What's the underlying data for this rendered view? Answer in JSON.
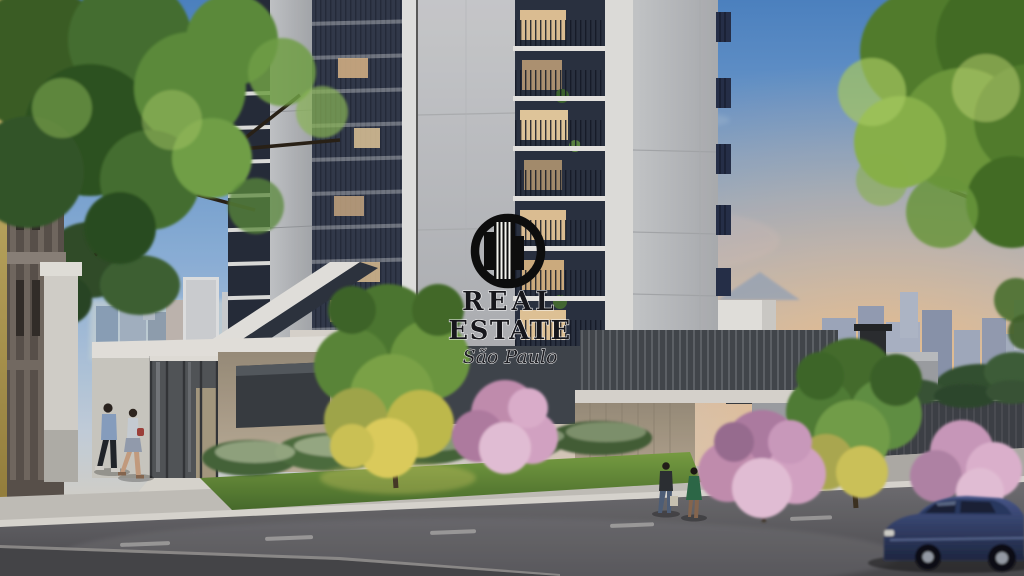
{
  "watermark": {
    "line1": "REAL",
    "line2": "ESTATE",
    "tagline": "São Paulo",
    "logo_icon": "circle-skyscraper-logo",
    "text_color": "#17171c",
    "outline_color": "#ffffff"
  },
  "palette": {
    "sky_blue": "#5a91cd",
    "sunset_orange": "#f2bd85",
    "facade_light_gray": "#c7c9cb",
    "balcony_dark": "#2b3244",
    "white_trim": "#eae7e1",
    "beige_wall": "#b3a591",
    "tree_green": "#5e8f3c",
    "lit_foliage_yellow": "#e3d35f",
    "blossom_pink": "#d8a3c4",
    "lawn_green": "#6f953f",
    "asphalt_gray": "#5b5a5e",
    "car_blue": "#31406b"
  }
}
